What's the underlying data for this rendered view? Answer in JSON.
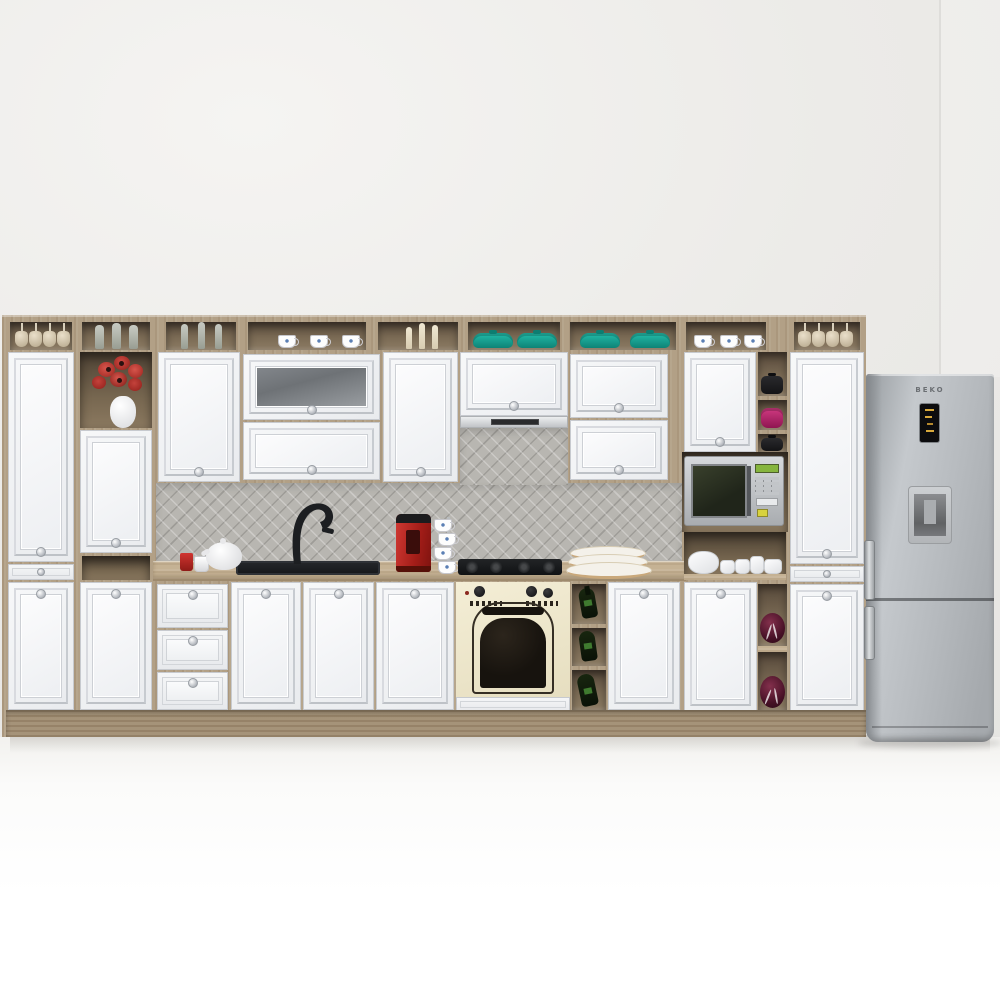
{
  "scene": {
    "type": "3d-kitchen-showroom-render",
    "description": "Classic white kitchen set with oak-tone open carcass, gray herringbone backsplash, cream retro oven and stainless refrigerator",
    "wall_color": "#eceae7",
    "floor_color": "#fbfbfa"
  },
  "palette": {
    "wood": "#b2a086",
    "wood_shadow": "#6b5c48",
    "cabinet_white": "#f1f2f4",
    "cabinet_frame": "#c7cacf",
    "backsplash_gray": "#b8b6b1",
    "countertop": "#c5b294",
    "teal_pots": "#17988a",
    "accent_red": "#b02420",
    "oven_cream": "#f0ead0",
    "oven_glass_black": "#17130e",
    "fridge_silver": "#b2b6ba",
    "maroon_decor": "#471126",
    "display_amber": "#d8a93c",
    "microwave_display_green": "#86b53e"
  },
  "appliances": {
    "fridge": {
      "brand": "BEKO",
      "features": [
        "electronic-display",
        "water-dispenser",
        "bottom-freezer",
        "bar-handles"
      ]
    },
    "oven": {
      "style": "retro-cream",
      "knobs": 3,
      "door": "arched-black-glass"
    },
    "hob": {
      "type": "gas",
      "burners": 4,
      "color": "black"
    },
    "hood": {
      "type": "slim-built-in",
      "finish": "stainless"
    },
    "microwave": {
      "finish": "silver",
      "display": "green",
      "buttons": "keypad + yellow start"
    },
    "sink": {
      "color": "black",
      "faucet": "black swan-neck"
    }
  },
  "top_shelf_items": [
    "hanging wine glasses",
    "glass tumblers",
    "champagne flutes",
    "floral tea cups",
    "cream candles",
    "teal casserole pots",
    "teal casserole pots",
    "floral tea cups",
    "hanging wine glasses"
  ],
  "counter_items": [
    "red mug",
    "white mug",
    "white teapot",
    "black inset sink",
    "black faucet",
    "red capsule coffee machine",
    "stacked white cups",
    "gas hob",
    "stacked rimmed plates"
  ],
  "decor": {
    "flower_niche": "red poppies in white vase",
    "open_shelf_pots": [
      "black pot",
      "magenta pot",
      "black pot"
    ],
    "tea_set_niche": "white porcelain tea set",
    "wine_rack_bottles": 3,
    "maroon_ornaments": 2,
    "teal_pot_count": 4
  },
  "counts": {
    "upper_doors": 9,
    "base_doors": 8,
    "drawers": 5,
    "tall_doors": 4
  }
}
